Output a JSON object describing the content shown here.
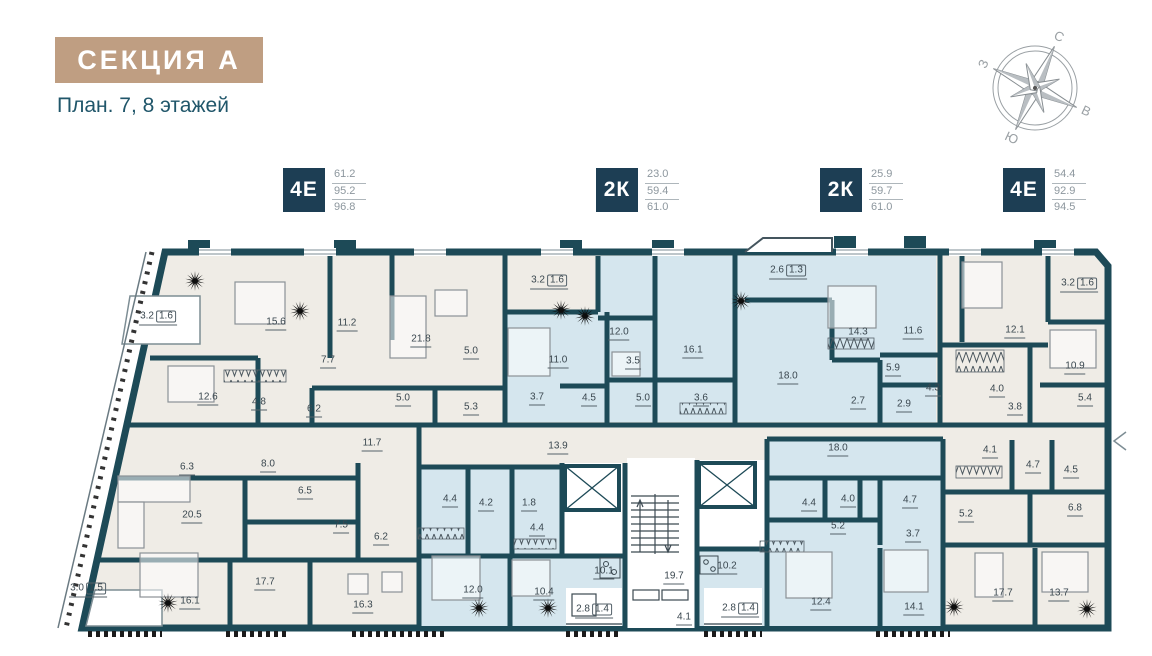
{
  "header": {
    "section_title": "СЕКЦИЯ А",
    "subtitle": "План. 7, 8 этажей"
  },
  "legend": {
    "items": [
      {
        "type": "4Е",
        "values": [
          "61.2",
          "95.2",
          "96.8"
        ],
        "x": 283
      },
      {
        "type": "2К",
        "values": [
          "23.0",
          "59.4",
          "61.0"
        ],
        "x": 596
      },
      {
        "type": "2К",
        "values": [
          "25.9",
          "59.7",
          "61.0"
        ],
        "x": 820
      },
      {
        "type": "4Е",
        "values": [
          "54.4",
          "92.9",
          "94.5"
        ],
        "x": 1003
      }
    ]
  },
  "compass": {
    "rotation_deg": 25,
    "labels": [
      {
        "text": "С",
        "angle": 25,
        "tilt": 25
      },
      {
        "text": "В",
        "angle": 115,
        "tilt": 25
      },
      {
        "text": "Ю",
        "angle": 205,
        "tilt": 25
      },
      {
        "text": "З",
        "angle": 295,
        "tilt": -65
      }
    ]
  },
  "colors": {
    "wall": "#1d4a57",
    "room_cream": "#efece6",
    "room_blue": "#d5e6ee",
    "title_bg": "#bf9e82",
    "heading_text": "#20566a",
    "badge_bg": "#1d3e54",
    "value_text": "#8d979e",
    "label_text": "#3a474f"
  },
  "plan": {
    "rooms": [
      {
        "v": "3.2",
        "s": "1.6",
        "x": 158,
        "y": 318
      },
      {
        "v": "15.6",
        "x": 276,
        "y": 324
      },
      {
        "v": "11.2",
        "x": 347,
        "y": 325
      },
      {
        "v": "21.8",
        "x": 421,
        "y": 341
      },
      {
        "v": "5.0",
        "x": 471,
        "y": 353
      },
      {
        "v": "12.6",
        "x": 208,
        "y": 399
      },
      {
        "v": "7.7",
        "x": 328,
        "y": 362
      },
      {
        "v": "4.8",
        "x": 259,
        "y": 404
      },
      {
        "v": "6.2",
        "x": 314,
        "y": 411
      },
      {
        "v": "5.0",
        "x": 403,
        "y": 400
      },
      {
        "v": "5.3",
        "x": 471,
        "y": 409
      },
      {
        "v": "3.2",
        "s": "1.6",
        "x": 549,
        "y": 282
      },
      {
        "v": "11.0",
        "x": 558,
        "y": 362
      },
      {
        "v": "12.0",
        "x": 619,
        "y": 334
      },
      {
        "v": "3.5",
        "x": 633,
        "y": 363
      },
      {
        "v": "16.1",
        "x": 693,
        "y": 352
      },
      {
        "v": "3.7",
        "x": 537,
        "y": 399
      },
      {
        "v": "4.5",
        "x": 589,
        "y": 400
      },
      {
        "v": "5.0",
        "x": 643,
        "y": 400
      },
      {
        "v": "3.6",
        "x": 701,
        "y": 400
      },
      {
        "v": "2.6",
        "s": "1.3",
        "x": 788,
        "y": 272
      },
      {
        "v": "18.0",
        "x": 788,
        "y": 378
      },
      {
        "v": "14.3",
        "x": 858,
        "y": 334
      },
      {
        "v": "11.6",
        "x": 913,
        "y": 333
      },
      {
        "v": "5.9",
        "x": 893,
        "y": 370
      },
      {
        "v": "4.3",
        "x": 933,
        "y": 390
      },
      {
        "v": "2.9",
        "x": 904,
        "y": 406
      },
      {
        "v": "2.7",
        "x": 858,
        "y": 403
      },
      {
        "v": "12.1",
        "x": 1015,
        "y": 332
      },
      {
        "v": "3.2",
        "s": "1.6",
        "x": 1079,
        "y": 285
      },
      {
        "v": "10.9",
        "x": 1075,
        "y": 368
      },
      {
        "v": "4.0",
        "x": 997,
        "y": 391
      },
      {
        "v": "3.8",
        "x": 1015,
        "y": 409
      },
      {
        "v": "5.4",
        "x": 1085,
        "y": 400
      },
      {
        "v": "13.9",
        "x": 558,
        "y": 448
      },
      {
        "v": "11.7",
        "x": 372,
        "y": 445
      },
      {
        "v": "4.1",
        "x": 990,
        "y": 452
      },
      {
        "v": "4.7",
        "x": 1033,
        "y": 467
      },
      {
        "v": "4.5",
        "x": 1071,
        "y": 472
      },
      {
        "v": "6.3",
        "x": 187,
        "y": 469
      },
      {
        "v": "8.0",
        "x": 268,
        "y": 466
      },
      {
        "v": "6.5",
        "x": 305,
        "y": 493
      },
      {
        "v": "20.5",
        "x": 192,
        "y": 517
      },
      {
        "v": "7.5",
        "x": 341,
        "y": 527
      },
      {
        "v": "6.2",
        "x": 381,
        "y": 539
      },
      {
        "v": "3.0",
        "s": "1.5",
        "x": 88,
        "y": 590
      },
      {
        "v": "16.1",
        "x": 190,
        "y": 603
      },
      {
        "v": "17.7",
        "x": 265,
        "y": 584
      },
      {
        "v": "16.3",
        "x": 363,
        "y": 607
      },
      {
        "v": "4.4",
        "x": 450,
        "y": 501
      },
      {
        "v": "4.2",
        "x": 486,
        "y": 505
      },
      {
        "v": "1.8",
        "x": 529,
        "y": 505
      },
      {
        "v": "4.4",
        "x": 537,
        "y": 530
      },
      {
        "v": "12.0",
        "x": 473,
        "y": 592
      },
      {
        "v": "10.4",
        "x": 544,
        "y": 594
      },
      {
        "v": "10.1",
        "x": 604,
        "y": 573
      },
      {
        "v": "2.8",
        "s": "1.4",
        "x": 594,
        "y": 611
      },
      {
        "v": "19.7",
        "x": 674,
        "y": 578
      },
      {
        "v": "4.1",
        "x": 684,
        "y": 619
      },
      {
        "v": "2.8",
        "s": "1.4",
        "x": 740,
        "y": 610
      },
      {
        "v": "10.2",
        "x": 727,
        "y": 568
      },
      {
        "v": "18.0",
        "x": 838,
        "y": 450
      },
      {
        "v": "4.4",
        "x": 809,
        "y": 505
      },
      {
        "v": "4.0",
        "x": 848,
        "y": 501
      },
      {
        "v": "5.2",
        "x": 838,
        "y": 528
      },
      {
        "v": "4.7",
        "x": 910,
        "y": 502
      },
      {
        "v": "3.7",
        "x": 913,
        "y": 536
      },
      {
        "v": "12.4",
        "x": 821,
        "y": 604
      },
      {
        "v": "14.1",
        "x": 914,
        "y": 609
      },
      {
        "v": "5.2",
        "x": 966,
        "y": 516
      },
      {
        "v": "6.8",
        "x": 1075,
        "y": 510
      },
      {
        "v": "17.7",
        "x": 1003,
        "y": 595
      },
      {
        "v": "13.7",
        "x": 1059,
        "y": 595
      }
    ],
    "stars": [
      [
        195,
        281
      ],
      [
        300,
        311
      ],
      [
        561,
        310
      ],
      [
        585,
        316
      ],
      [
        741,
        301
      ],
      [
        168,
        603
      ],
      [
        479,
        608
      ],
      [
        548,
        608
      ],
      [
        954,
        607
      ],
      [
        1087,
        609
      ]
    ]
  }
}
